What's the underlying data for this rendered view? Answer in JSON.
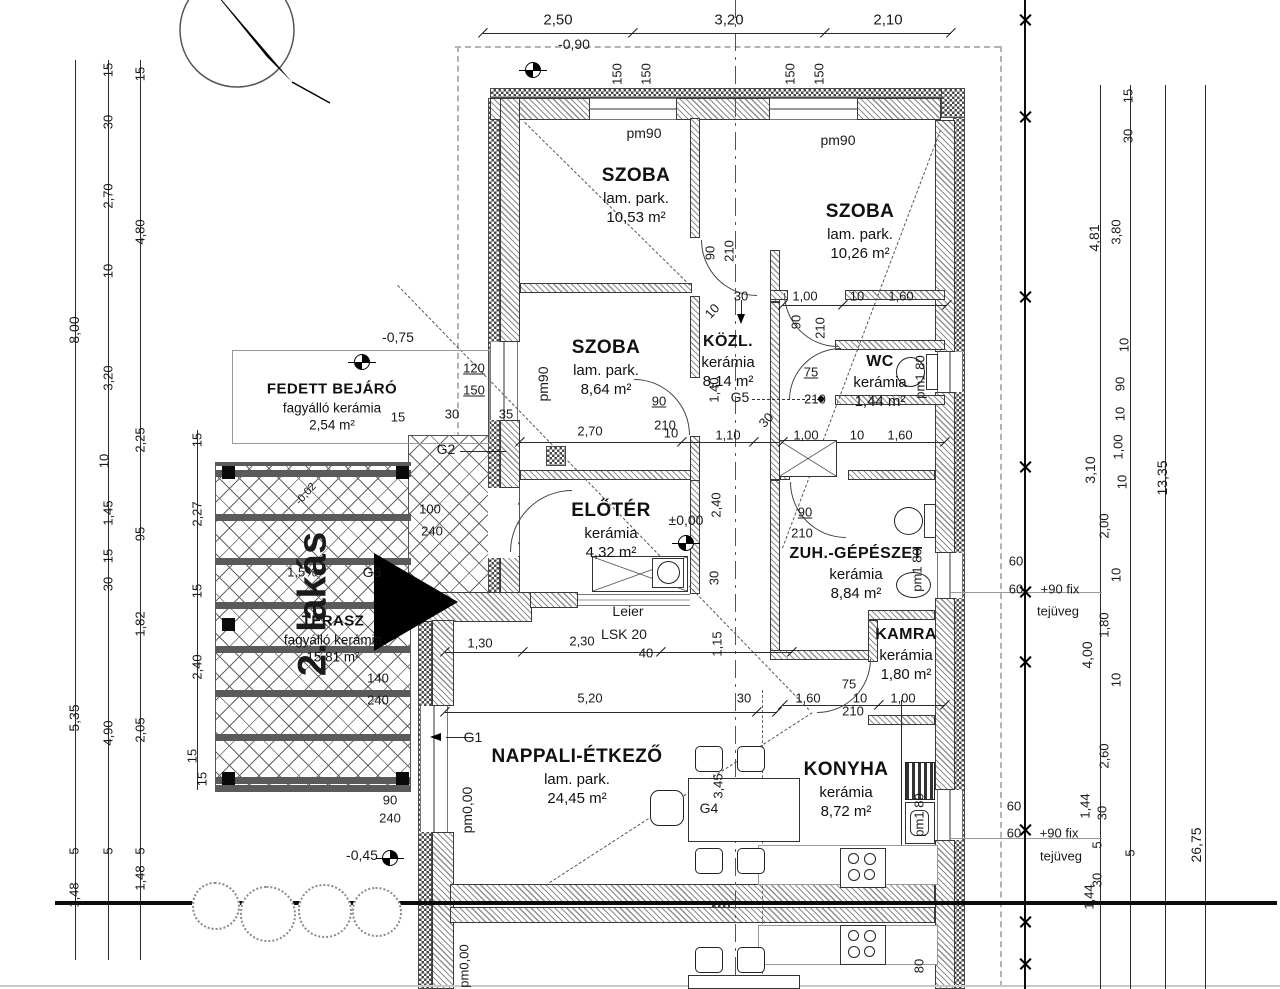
{
  "drawing_type": "apartment floor plan",
  "rooms": [
    {
      "name": "SZOBA",
      "finish": "lam. park.",
      "area": "10,53 m²"
    },
    {
      "name": "SZOBA",
      "finish": "lam. park.",
      "area": "10,26 m²"
    },
    {
      "name": "SZOBA",
      "finish": "lam. park.",
      "area": "8,64 m²"
    },
    {
      "name": "KÖZL.",
      "finish": "kerámia",
      "area": "8,14 m²"
    },
    {
      "name": "WC",
      "finish": "kerámia",
      "area": "1,44 m²"
    },
    {
      "name": "ELŐTÉR",
      "finish": "kerámia",
      "area": "4,32 m²"
    },
    {
      "name": "ZUH.-GÉPÉSZET",
      "finish": "kerámia",
      "area": "8,84 m²"
    },
    {
      "name": "KAMRA",
      "finish": "kerámia",
      "area": "1,80 m²"
    },
    {
      "name": "NAPPALI-ÉT KEZŐ",
      "finish": "lam. park.",
      "area": "24,45 m²"
    },
    {
      "name": "KONYHA",
      "finish": "kerámia",
      "area": "8,72 m²"
    },
    {
      "name": "FEDETT BEJÁRÓ",
      "finish": "fagyálló kerámia",
      "area": "2,54 m²"
    },
    {
      "name": "TERASZ",
      "finish": "fagyálló kerámia",
      "area": "15,81 m²"
    }
  ],
  "annotations": [
    {
      "n": "dim",
      "t": "2,50",
      "x": 558,
      "y": 20,
      "s": 15
    },
    {
      "n": "dim",
      "t": "3,20",
      "x": 729,
      "y": 20,
      "s": 15
    },
    {
      "n": "dim",
      "t": "2,10",
      "x": 888,
      "y": 20,
      "s": 15
    },
    {
      "n": "level",
      "t": "-0,90",
      "x": 574,
      "y": 44,
      "s": 14
    },
    {
      "n": "window-height",
      "t": "150",
      "x": 617,
      "y": 74,
      "r": "v"
    },
    {
      "n": "window-height",
      "t": "150",
      "x": 646,
      "y": 74,
      "r": "v"
    },
    {
      "n": "window-height",
      "t": "150",
      "x": 790,
      "y": 74,
      "r": "v"
    },
    {
      "n": "window-height",
      "t": "150",
      "x": 819,
      "y": 74,
      "r": "v"
    },
    {
      "n": "dim",
      "t": "15",
      "x": 108,
      "y": 70,
      "r": "v"
    },
    {
      "n": "dim",
      "t": "30",
      "x": 108,
      "y": 122,
      "r": "v"
    },
    {
      "n": "dim",
      "t": "2,70",
      "x": 108,
      "y": 196,
      "r": "v"
    },
    {
      "n": "dim",
      "t": "10",
      "x": 108,
      "y": 271,
      "r": "v"
    },
    {
      "n": "dim",
      "t": "3,20",
      "x": 108,
      "y": 378,
      "r": "v"
    },
    {
      "n": "dim",
      "t": "10",
      "x": 104,
      "y": 461,
      "r": "v"
    },
    {
      "n": "dim",
      "t": "1,45",
      "x": 108,
      "y": 513,
      "r": "v"
    },
    {
      "n": "dim",
      "t": "15",
      "x": 108,
      "y": 556,
      "r": "v"
    },
    {
      "n": "dim",
      "t": "30",
      "x": 108,
      "y": 584,
      "r": "v"
    },
    {
      "n": "dim",
      "t": "4,90",
      "x": 108,
      "y": 733,
      "r": "v"
    },
    {
      "n": "dim",
      "t": "5",
      "x": 108,
      "y": 851,
      "r": "v"
    },
    {
      "n": "dim",
      "t": "8,00",
      "x": 74,
      "y": 330,
      "r": "v",
      "s": 14
    },
    {
      "n": "dim",
      "t": "5,35",
      "x": 74,
      "y": 718,
      "r": "v",
      "s": 14
    },
    {
      "n": "dim",
      "t": "5",
      "x": 74,
      "y": 851,
      "r": "v"
    },
    {
      "n": "dim",
      "t": "1,48",
      "x": 74,
      "y": 895,
      "r": "v"
    },
    {
      "n": "dim",
      "t": "15",
      "x": 140,
      "y": 74,
      "r": "v"
    },
    {
      "n": "dim",
      "t": "4,80",
      "x": 140,
      "y": 232,
      "r": "v"
    },
    {
      "n": "dim",
      "t": "2,25",
      "x": 140,
      "y": 440,
      "r": "v"
    },
    {
      "n": "dim",
      "t": "95",
      "x": 140,
      "y": 534,
      "r": "v"
    },
    {
      "n": "dim",
      "t": "1,82",
      "x": 140,
      "y": 624,
      "r": "v"
    },
    {
      "n": "dim",
      "t": "2,05",
      "x": 140,
      "y": 730,
      "r": "v"
    },
    {
      "n": "dim",
      "t": "5",
      "x": 140,
      "y": 851,
      "r": "v"
    },
    {
      "n": "dim",
      "t": "1,48",
      "x": 140,
      "y": 878,
      "r": "v"
    },
    {
      "n": "dim",
      "t": "15",
      "x": 197,
      "y": 440,
      "r": "v"
    },
    {
      "n": "dim",
      "t": "2,27",
      "x": 197,
      "y": 514,
      "r": "v"
    },
    {
      "n": "dim",
      "t": "15",
      "x": 197,
      "y": 591,
      "r": "v"
    },
    {
      "n": "dim",
      "t": "2,40",
      "x": 197,
      "y": 667,
      "r": "v"
    },
    {
      "n": "dim",
      "t": "15",
      "x": 192,
      "y": 756,
      "r": "v"
    },
    {
      "n": "dim",
      "t": "15",
      "x": 202,
      "y": 779,
      "r": "v"
    },
    {
      "n": "dim",
      "t": "15",
      "x": 1128,
      "y": 96,
      "r": "v"
    },
    {
      "n": "dim",
      "t": "30",
      "x": 1128,
      "y": 136,
      "r": "v"
    },
    {
      "n": "dim",
      "t": "3,80",
      "x": 1116,
      "y": 232,
      "r": "v"
    },
    {
      "n": "dim",
      "t": "4,81",
      "x": 1094,
      "y": 238,
      "r": "v",
      "s": 14
    },
    {
      "n": "dim",
      "t": "10",
      "x": 1124,
      "y": 345,
      "r": "v"
    },
    {
      "n": "dim",
      "t": "90",
      "x": 1120,
      "y": 384,
      "r": "v"
    },
    {
      "n": "dim",
      "t": "10",
      "x": 1120,
      "y": 414,
      "r": "v"
    },
    {
      "n": "dim",
      "t": "1,00",
      "x": 1118,
      "y": 447,
      "r": "v"
    },
    {
      "n": "dim",
      "t": "3,10",
      "x": 1090,
      "y": 470,
      "r": "v",
      "s": 14
    },
    {
      "n": "dim",
      "t": "13,35",
      "x": 1162,
      "y": 478,
      "r": "v",
      "s": 14
    },
    {
      "n": "dim",
      "t": "10",
      "x": 1122,
      "y": 482,
      "r": "v"
    },
    {
      "n": "dim",
      "t": "2,00",
      "x": 1104,
      "y": 526,
      "r": "v"
    },
    {
      "n": "dim",
      "t": "10",
      "x": 1116,
      "y": 575,
      "r": "v"
    },
    {
      "n": "dim",
      "t": "1,80",
      "x": 1104,
      "y": 625,
      "r": "v"
    },
    {
      "n": "dim",
      "t": "4,00",
      "x": 1087,
      "y": 655,
      "r": "v",
      "s": 14
    },
    {
      "n": "dim",
      "t": "10",
      "x": 1116,
      "y": 680,
      "r": "v"
    },
    {
      "n": "dim",
      "t": "2,60",
      "x": 1104,
      "y": 756,
      "r": "v"
    },
    {
      "n": "dim",
      "t": "1,44",
      "x": 1085,
      "y": 806,
      "r": "v"
    },
    {
      "n": "dim",
      "t": "30",
      "x": 1102,
      "y": 813,
      "r": "v"
    },
    {
      "n": "dim",
      "t": "5",
      "x": 1097,
      "y": 845,
      "r": "v"
    },
    {
      "n": "dim",
      "t": "5",
      "x": 1130,
      "y": 853,
      "r": "v"
    },
    {
      "n": "dim",
      "t": "26,75",
      "x": 1196,
      "y": 845,
      "r": "v",
      "s": 14
    },
    {
      "n": "dim",
      "t": "30",
      "x": 1097,
      "y": 880,
      "r": "v"
    },
    {
      "n": "dim",
      "t": "1,44",
      "x": 1089,
      "y": 897,
      "r": "v"
    },
    {
      "n": "glass-note",
      "t": "60",
      "x": 1016,
      "y": 561
    },
    {
      "n": "glass-note",
      "t": "60",
      "x": 1016,
      "y": 589
    },
    {
      "n": "glass-note",
      "t": "+90 fix",
      "x": 1060,
      "y": 589
    },
    {
      "n": "glass-note",
      "t": "tejüveg",
      "x": 1058,
      "y": 611
    },
    {
      "n": "glass-note",
      "t": "60",
      "x": 1014,
      "y": 806
    },
    {
      "n": "glass-note",
      "t": "60",
      "x": 1014,
      "y": 833
    },
    {
      "n": "glass-note",
      "t": "+90 fix",
      "x": 1059,
      "y": 833
    },
    {
      "n": "glass-note",
      "t": "tejüveg",
      "x": 1061,
      "y": 856
    },
    {
      "n": "window-id",
      "t": "pm90",
      "x": 644,
      "y": 133,
      "s": 14
    },
    {
      "n": "window-id",
      "t": "pm90",
      "x": 838,
      "y": 140,
      "s": 14
    },
    {
      "n": "window-id",
      "t": "pm90",
      "x": 543,
      "y": 384,
      "r": "v",
      "s": 14
    },
    {
      "n": "dim",
      "t": "120",
      "x": 474,
      "y": 368,
      "u": 1
    },
    {
      "n": "dim",
      "t": "150",
      "x": 474,
      "y": 390,
      "u": 1
    },
    {
      "n": "level",
      "t": "-0,75",
      "x": 398,
      "y": 337,
      "s": 14
    },
    {
      "n": "dim",
      "t": "15",
      "x": 398,
      "y": 417
    },
    {
      "n": "dim",
      "t": "30",
      "x": 452,
      "y": 414
    },
    {
      "n": "dim",
      "t": "35",
      "x": 506,
      "y": 414
    },
    {
      "n": "girder",
      "t": "G2",
      "x": 446,
      "y": 449,
      "s": 14
    },
    {
      "n": "door-size",
      "t": "100",
      "x": 430,
      "y": 509
    },
    {
      "n": "door-size",
      "t": "240",
      "x": 432,
      "y": 531
    },
    {
      "n": "level",
      "t": "-0,02",
      "x": 306,
      "y": 494,
      "r": "d",
      "s": 11
    },
    {
      "n": "slope",
      "t": "1,5%",
      "x": 302,
      "y": 572
    },
    {
      "n": "girder",
      "t": "G3",
      "x": 372,
      "y": 572,
      "s": 14
    },
    {
      "n": "unit-label",
      "t": "2. lakás",
      "x": 313,
      "y": 604,
      "r": "v",
      "s": 40,
      "b": 1
    },
    {
      "n": "door-size",
      "t": "140",
      "x": 378,
      "y": 678
    },
    {
      "n": "door-size",
      "t": "240",
      "x": 378,
      "y": 700
    },
    {
      "n": "door-size",
      "t": "90",
      "x": 390,
      "y": 800
    },
    {
      "n": "door-size",
      "t": "240",
      "x": 390,
      "y": 818
    },
    {
      "n": "window-id",
      "t": "pm0,00",
      "x": 467,
      "y": 810,
      "r": "v",
      "s": 14
    },
    {
      "n": "girder",
      "t": "G1",
      "x": 473,
      "y": 737,
      "s": 14
    },
    {
      "n": "level",
      "t": "-0,45",
      "x": 362,
      "y": 855,
      "s": 14
    },
    {
      "n": "level",
      "t": "±0,00",
      "x": 686,
      "y": 520,
      "s": 14
    },
    {
      "n": "lintel",
      "t": "Leier",
      "x": 628,
      "y": 611,
      "s": 14
    },
    {
      "n": "lintel",
      "t": "LSK 20",
      "x": 624,
      "y": 634,
      "s": 14
    },
    {
      "n": "lintel",
      "t": "40",
      "x": 646,
      "y": 653
    },
    {
      "n": "dim",
      "t": "1,30",
      "x": 480,
      "y": 643
    },
    {
      "n": "dim",
      "t": "2,30",
      "x": 582,
      "y": 641
    },
    {
      "n": "dim",
      "t": "1,15",
      "x": 717,
      "y": 644,
      "r": "v"
    },
    {
      "n": "dim",
      "t": "30",
      "x": 714,
      "y": 578,
      "r": "v"
    },
    {
      "n": "dim",
      "t": "2,40",
      "x": 716,
      "y": 505,
      "r": "v"
    },
    {
      "n": "dim",
      "t": "5,20",
      "x": 590,
      "y": 698
    },
    {
      "n": "dim",
      "t": "30",
      "x": 744,
      "y": 698
    },
    {
      "n": "girder",
      "t": "G4",
      "x": 709,
      "y": 808,
      "s": 14
    },
    {
      "n": "dim",
      "t": "3,45",
      "x": 718,
      "y": 786,
      "r": "v"
    },
    {
      "n": "dim",
      "t": "2,70",
      "x": 590,
      "y": 431
    },
    {
      "n": "dim",
      "t": "10",
      "x": 671,
      "y": 433
    },
    {
      "n": "dim",
      "t": "1,10",
      "x": 728,
      "y": 435
    },
    {
      "n": "dim",
      "t": "30",
      "x": 766,
      "y": 420,
      "r": "d"
    },
    {
      "n": "dim",
      "t": "30",
      "x": 741,
      "y": 296
    },
    {
      "n": "dim",
      "t": "10",
      "x": 712,
      "y": 311,
      "r": "d"
    },
    {
      "n": "door-size",
      "t": "90",
      "x": 710,
      "y": 253,
      "r": "v"
    },
    {
      "n": "door-size",
      "t": "210",
      "x": 729,
      "y": 251,
      "r": "v"
    },
    {
      "n": "dim",
      "t": "1,40",
      "x": 714,
      "y": 390,
      "r": "v"
    },
    {
      "n": "girder",
      "t": "G5",
      "x": 740,
      "y": 397,
      "s": 14
    },
    {
      "n": "door-size",
      "t": "90",
      "x": 659,
      "y": 401,
      "u": 1
    },
    {
      "n": "door-size",
      "t": "210",
      "x": 665,
      "y": 425
    },
    {
      "n": "dim",
      "t": "1,00",
      "x": 805,
      "y": 296
    },
    {
      "n": "dim",
      "t": "10",
      "x": 857,
      "y": 296
    },
    {
      "n": "dim",
      "t": "1,60",
      "x": 901,
      "y": 296
    },
    {
      "n": "door-size",
      "t": "90",
      "x": 796,
      "y": 322,
      "r": "v"
    },
    {
      "n": "door-size",
      "t": "210",
      "x": 820,
      "y": 328,
      "r": "v"
    },
    {
      "n": "dim",
      "t": "1,00",
      "x": 806,
      "y": 435
    },
    {
      "n": "dim",
      "t": "10",
      "x": 857,
      "y": 435
    },
    {
      "n": "dim",
      "t": "1,60",
      "x": 900,
      "y": 435
    },
    {
      "n": "door-size",
      "t": "75",
      "x": 811,
      "y": 372,
      "u": 1
    },
    {
      "n": "door-size",
      "t": "210",
      "x": 815,
      "y": 399
    },
    {
      "n": "door-size",
      "t": "90",
      "x": 805,
      "y": 512,
      "u": 1
    },
    {
      "n": "door-size",
      "t": "210",
      "x": 802,
      "y": 533
    },
    {
      "n": "window-id",
      "t": "pm1 80",
      "x": 920,
      "y": 377,
      "r": "v"
    },
    {
      "n": "window-id",
      "t": "pm1 80",
      "x": 917,
      "y": 570,
      "r": "v"
    },
    {
      "n": "window-id",
      "t": "pm1 80",
      "x": 919,
      "y": 815,
      "r": "v"
    },
    {
      "n": "door-size",
      "t": "75",
      "x": 849,
      "y": 684
    },
    {
      "n": "door-size",
      "t": "210",
      "x": 853,
      "y": 711
    },
    {
      "n": "dim",
      "t": "1,60",
      "x": 808,
      "y": 698
    },
    {
      "n": "dim",
      "t": "10",
      "x": 860,
      "y": 698
    },
    {
      "n": "dim",
      "t": "1,00",
      "x": 903,
      "y": 698
    },
    {
      "n": "window-id",
      "t": "pm0,00",
      "x": 464,
      "y": 966,
      "r": "v"
    },
    {
      "n": "window-id",
      "t": "80",
      "x": 919,
      "y": 966,
      "r": "v"
    }
  ]
}
